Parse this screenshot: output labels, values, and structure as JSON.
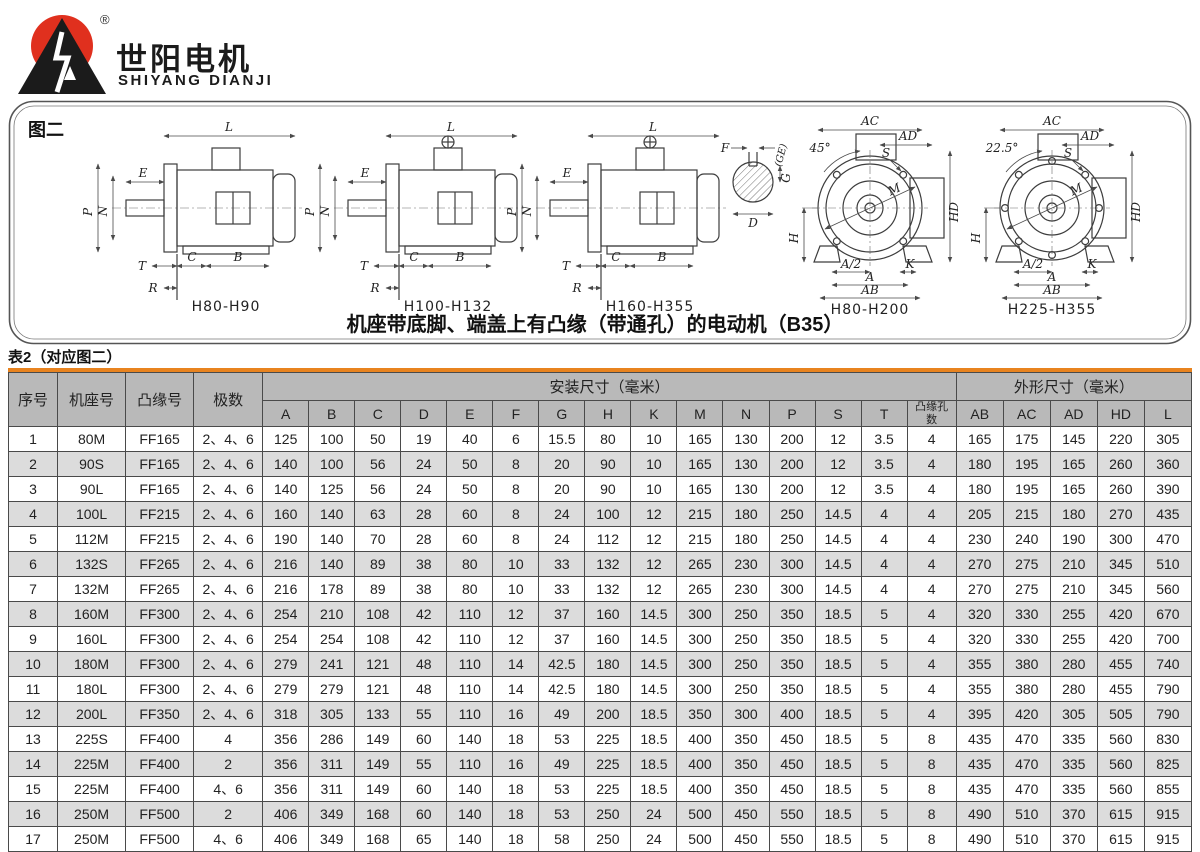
{
  "logo": {
    "brand_cn": "世阳电机",
    "brand_en": "SHIYANG DIANJI",
    "registered": "®"
  },
  "figure": {
    "label": "图二",
    "caption": "机座带底脚、端盖上有凸缘（带通孔）的电动机（B35）",
    "side_view_names": [
      "H80-H90",
      "H100-H132",
      "H160-H355"
    ],
    "front_view_names": [
      "H80-H200",
      "H225-H355"
    ],
    "front_view_angles": [
      "45°",
      "22.5°"
    ],
    "dims": {
      "L": "L",
      "E": "E",
      "P": "P",
      "N": "N",
      "T": "T",
      "R": "R",
      "C": "C",
      "B": "B",
      "F": "F",
      "GE": "(GE)",
      "G": "G",
      "D": "D",
      "AC": "AC",
      "AD": "AD",
      "S": "S",
      "M": "M",
      "HD": "HD",
      "H": "H",
      "A_half": "A/2",
      "A": "A",
      "AB": "AB",
      "K": "K"
    }
  },
  "table": {
    "title": "表2（对应图二）",
    "headers": {
      "index": "序号",
      "frame": "机座号",
      "flange": "凸缘号",
      "poles": "极数",
      "install_group": "安装尺寸（毫米）",
      "outline_group": "外形尺寸（毫米）",
      "flange_holes": "凸缘孔数"
    },
    "install_cols": [
      "A",
      "B",
      "C",
      "D",
      "E",
      "F",
      "G",
      "H",
      "K",
      "M",
      "N",
      "P",
      "S",
      "T"
    ],
    "outline_cols": [
      "AB",
      "AC",
      "AD",
      "HD",
      "L"
    ],
    "rows": [
      [
        "1",
        "80M",
        "FF165",
        "2、4、6",
        "125",
        "100",
        "50",
        "19",
        "40",
        "6",
        "15.5",
        "80",
        "10",
        "165",
        "130",
        "200",
        "12",
        "3.5",
        "4",
        "165",
        "175",
        "145",
        "220",
        "305"
      ],
      [
        "2",
        "90S",
        "FF165",
        "2、4、6",
        "140",
        "100",
        "56",
        "24",
        "50",
        "8",
        "20",
        "90",
        "10",
        "165",
        "130",
        "200",
        "12",
        "3.5",
        "4",
        "180",
        "195",
        "165",
        "260",
        "360"
      ],
      [
        "3",
        "90L",
        "FF165",
        "2、4、6",
        "140",
        "125",
        "56",
        "24",
        "50",
        "8",
        "20",
        "90",
        "10",
        "165",
        "130",
        "200",
        "12",
        "3.5",
        "4",
        "180",
        "195",
        "165",
        "260",
        "390"
      ],
      [
        "4",
        "100L",
        "FF215",
        "2、4、6",
        "160",
        "140",
        "63",
        "28",
        "60",
        "8",
        "24",
        "100",
        "12",
        "215",
        "180",
        "250",
        "14.5",
        "4",
        "4",
        "205",
        "215",
        "180",
        "270",
        "435"
      ],
      [
        "5",
        "112M",
        "FF215",
        "2、4、6",
        "190",
        "140",
        "70",
        "28",
        "60",
        "8",
        "24",
        "112",
        "12",
        "215",
        "180",
        "250",
        "14.5",
        "4",
        "4",
        "230",
        "240",
        "190",
        "300",
        "470"
      ],
      [
        "6",
        "132S",
        "FF265",
        "2、4、6",
        "216",
        "140",
        "89",
        "38",
        "80",
        "10",
        "33",
        "132",
        "12",
        "265",
        "230",
        "300",
        "14.5",
        "4",
        "4",
        "270",
        "275",
        "210",
        "345",
        "510"
      ],
      [
        "7",
        "132M",
        "FF265",
        "2、4、6",
        "216",
        "178",
        "89",
        "38",
        "80",
        "10",
        "33",
        "132",
        "12",
        "265",
        "230",
        "300",
        "14.5",
        "4",
        "4",
        "270",
        "275",
        "210",
        "345",
        "560"
      ],
      [
        "8",
        "160M",
        "FF300",
        "2、4、6",
        "254",
        "210",
        "108",
        "42",
        "110",
        "12",
        "37",
        "160",
        "14.5",
        "300",
        "250",
        "350",
        "18.5",
        "5",
        "4",
        "320",
        "330",
        "255",
        "420",
        "670"
      ],
      [
        "9",
        "160L",
        "FF300",
        "2、4、6",
        "254",
        "254",
        "108",
        "42",
        "110",
        "12",
        "37",
        "160",
        "14.5",
        "300",
        "250",
        "350",
        "18.5",
        "5",
        "4",
        "320",
        "330",
        "255",
        "420",
        "700"
      ],
      [
        "10",
        "180M",
        "FF300",
        "2、4、6",
        "279",
        "241",
        "121",
        "48",
        "110",
        "14",
        "42.5",
        "180",
        "14.5",
        "300",
        "250",
        "350",
        "18.5",
        "5",
        "4",
        "355",
        "380",
        "280",
        "455",
        "740"
      ],
      [
        "11",
        "180L",
        "FF300",
        "2、4、6",
        "279",
        "279",
        "121",
        "48",
        "110",
        "14",
        "42.5",
        "180",
        "14.5",
        "300",
        "250",
        "350",
        "18.5",
        "5",
        "4",
        "355",
        "380",
        "280",
        "455",
        "790"
      ],
      [
        "12",
        "200L",
        "FF350",
        "2、4、6",
        "318",
        "305",
        "133",
        "55",
        "110",
        "16",
        "49",
        "200",
        "18.5",
        "350",
        "300",
        "400",
        "18.5",
        "5",
        "4",
        "395",
        "420",
        "305",
        "505",
        "790"
      ],
      [
        "13",
        "225S",
        "FF400",
        "4",
        "356",
        "286",
        "149",
        "60",
        "140",
        "18",
        "53",
        "225",
        "18.5",
        "400",
        "350",
        "450",
        "18.5",
        "5",
        "8",
        "435",
        "470",
        "335",
        "560",
        "830"
      ],
      [
        "14",
        "225M",
        "FF400",
        "2",
        "356",
        "311",
        "149",
        "55",
        "110",
        "16",
        "49",
        "225",
        "18.5",
        "400",
        "350",
        "450",
        "18.5",
        "5",
        "8",
        "435",
        "470",
        "335",
        "560",
        "825"
      ],
      [
        "15",
        "225M",
        "FF400",
        "4、6",
        "356",
        "311",
        "149",
        "60",
        "140",
        "18",
        "53",
        "225",
        "18.5",
        "400",
        "350",
        "450",
        "18.5",
        "5",
        "8",
        "435",
        "470",
        "335",
        "560",
        "855"
      ],
      [
        "16",
        "250M",
        "FF500",
        "2",
        "406",
        "349",
        "168",
        "60",
        "140",
        "18",
        "53",
        "250",
        "24",
        "500",
        "450",
        "550",
        "18.5",
        "5",
        "8",
        "490",
        "510",
        "370",
        "615",
        "915"
      ],
      [
        "17",
        "250M",
        "FF500",
        "4、6",
        "406",
        "349",
        "168",
        "65",
        "140",
        "18",
        "58",
        "250",
        "24",
        "500",
        "450",
        "550",
        "18.5",
        "5",
        "8",
        "490",
        "510",
        "370",
        "615",
        "915"
      ]
    ]
  },
  "colors": {
    "accent_orange": "#E8831F",
    "header_gray": "#b9b9b9",
    "row_alt_gray": "#dcdcdc",
    "logo_red": "#e0301e"
  }
}
